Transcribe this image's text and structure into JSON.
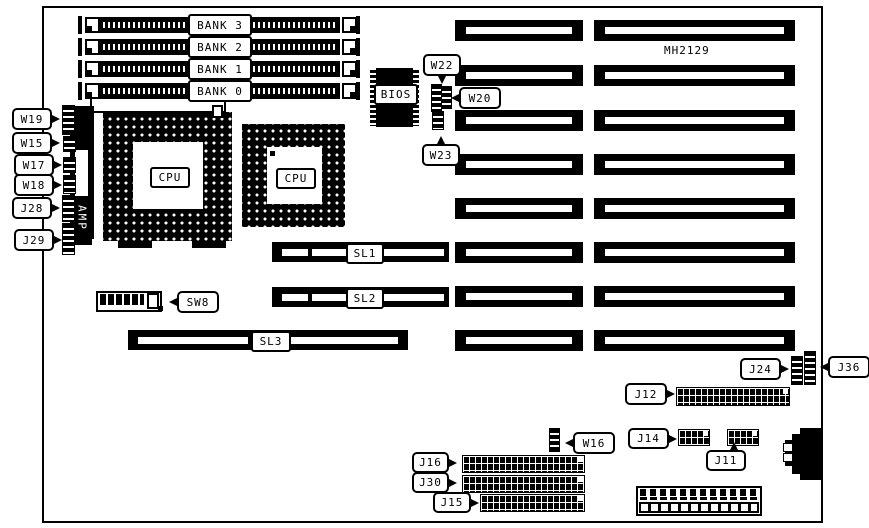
{
  "board": {
    "model": "MH2129"
  },
  "colors": {
    "ink": "#000000",
    "paper": "#ffffff"
  },
  "memory": {
    "banks": [
      "BANK 3",
      "BANK 2",
      "BANK 1",
      "BANK 0"
    ]
  },
  "cpu": {
    "socket1_label": "CPU",
    "socket2_label": "CPU"
  },
  "chips": {
    "bios": "BIOS",
    "amp": "AMP"
  },
  "bus_slots": {
    "sl1": "SL1",
    "sl2": "SL2",
    "sl3": "SL3"
  },
  "switches": {
    "sw8": "SW8"
  },
  "jumpers": {
    "w19": "W19",
    "w15": "W15",
    "w17": "W17",
    "w18": "W18",
    "j28": "J28",
    "j29": "J29",
    "w22": "W22",
    "w20": "W20",
    "w23": "W23",
    "w16": "W16",
    "j24": "J24",
    "j36": "J36"
  },
  "connectors": {
    "j12": "J12",
    "j14": "J14",
    "j11": "J11",
    "j16": "J16",
    "j30": "J30",
    "j15": "J15"
  }
}
